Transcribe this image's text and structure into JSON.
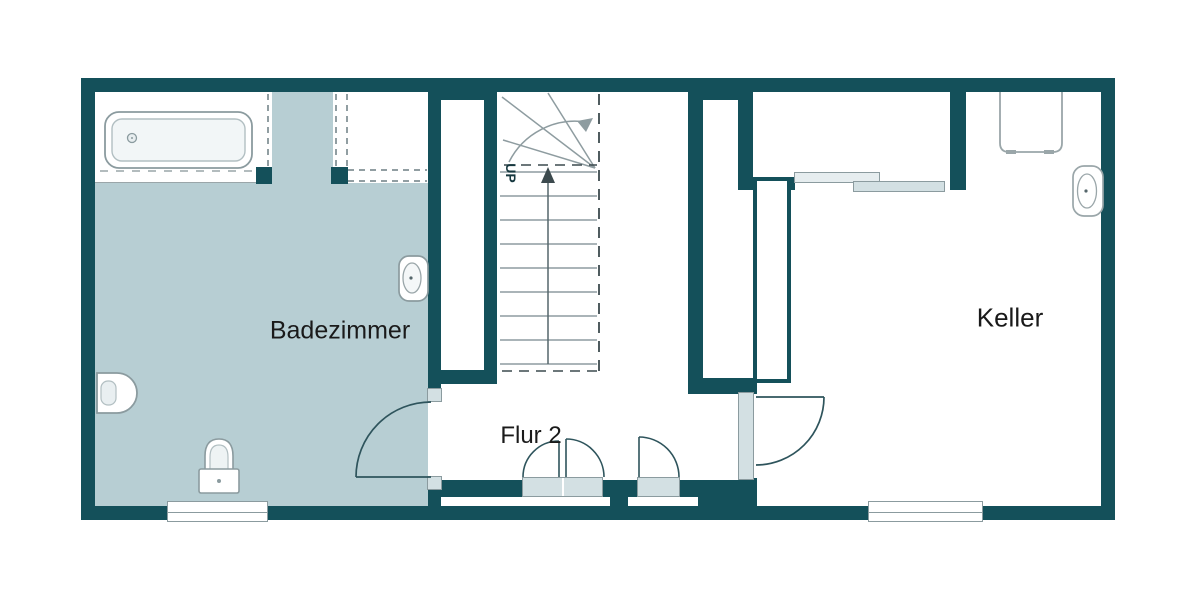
{
  "plan": {
    "type": "basement floor plan",
    "labels": {
      "bathroom": "Badezimmer",
      "hallway": "Flur 2",
      "basement": "Keller",
      "stairs_direction": "UP"
    },
    "rooms": [
      {
        "name": "Badezimmer",
        "fixtures": [
          "bathtub",
          "shower",
          "wall-sink",
          "bidet",
          "toilet",
          "window"
        ]
      },
      {
        "name": "Flur 2",
        "fixtures": [
          "swing-door-to-bathroom",
          "double-closet-doors",
          "closet-door",
          "door-to-keller"
        ]
      },
      {
        "name": "Keller",
        "fixtures": [
          "storage-room-sliding-door",
          "appliance",
          "wall-sink",
          "window"
        ]
      },
      {
        "name": "staircase",
        "fixtures": [
          "winder-stairs",
          "up-arrow",
          "walk-line"
        ]
      }
    ],
    "colors": {
      "wall": "#14505a",
      "bathroom_floor": "#b7ced3",
      "fixture_outline": "#8b9b9f",
      "door_sill": "#d3e0e3",
      "door_arc": "#2e545c",
      "background": "#ffffff"
    }
  }
}
